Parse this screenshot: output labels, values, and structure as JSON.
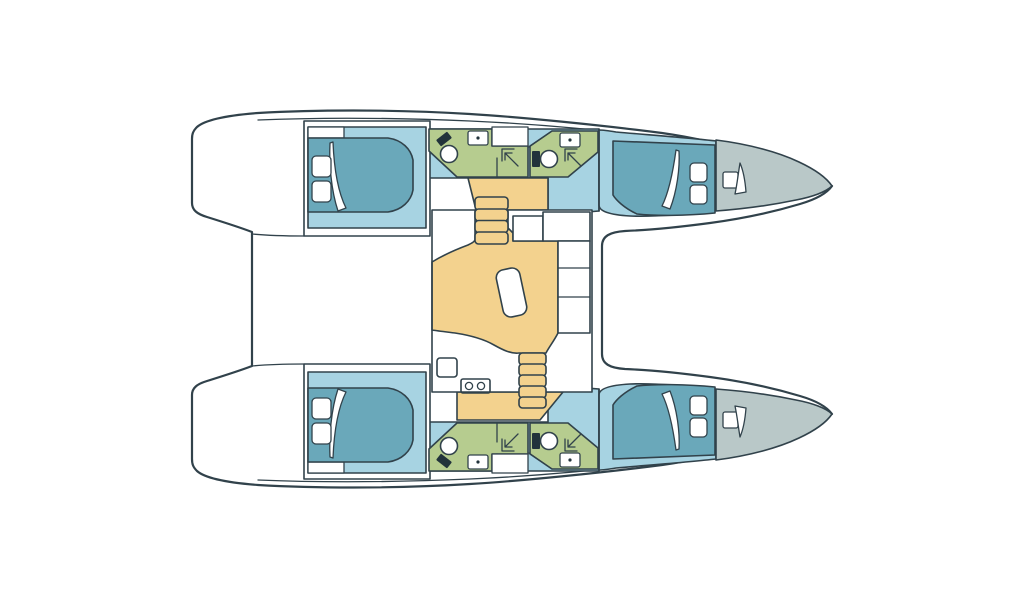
{
  "colors": {
    "background": "#ffffff",
    "outline": "#31424b",
    "deck_white": "#ffffff",
    "cabin_floor_blue": "#a7d3e2",
    "bed_teal": "#6aa8ba",
    "bathroom_green": "#b6cc8f",
    "salon_floor_yellow": "#f3d28e",
    "forepeak_grey": "#b9c8c8",
    "fixture_dark": "#22333b"
  },
  "plan": {
    "type": "floor-plan",
    "vessel": "catamaran",
    "view": "top-down deck plan, bow to the right",
    "hulls": [
      {
        "id": "upper-hull",
        "rooms": [
          "aft-double-cabin",
          "aft-head",
          "forward-head",
          "forward-double-cabin",
          "forepeak-locker"
        ],
        "fixtures": [
          "island-bed",
          "pillows",
          "duvet-fold",
          "toilet",
          "washbasin",
          "shower",
          "deck-hatch"
        ]
      },
      {
        "id": "lower-hull",
        "rooms": [
          "aft-double-cabin",
          "aft-head",
          "forward-head",
          "forward-double-cabin",
          "forepeak-locker"
        ],
        "fixtures": [
          "island-bed",
          "pillows",
          "duvet-fold",
          "toilet",
          "washbasin",
          "shower",
          "deck-hatch"
        ]
      }
    ],
    "bridgedeck": {
      "rooms": [
        "aft-cockpit",
        "salon",
        "galley"
      ],
      "fixtures": [
        "l-shaped-settee",
        "side-settee",
        "dinette-table",
        "galley-sink-double",
        "fridge-locker",
        "companionway-stairs-port",
        "companionway-stairs-starboard"
      ]
    }
  }
}
